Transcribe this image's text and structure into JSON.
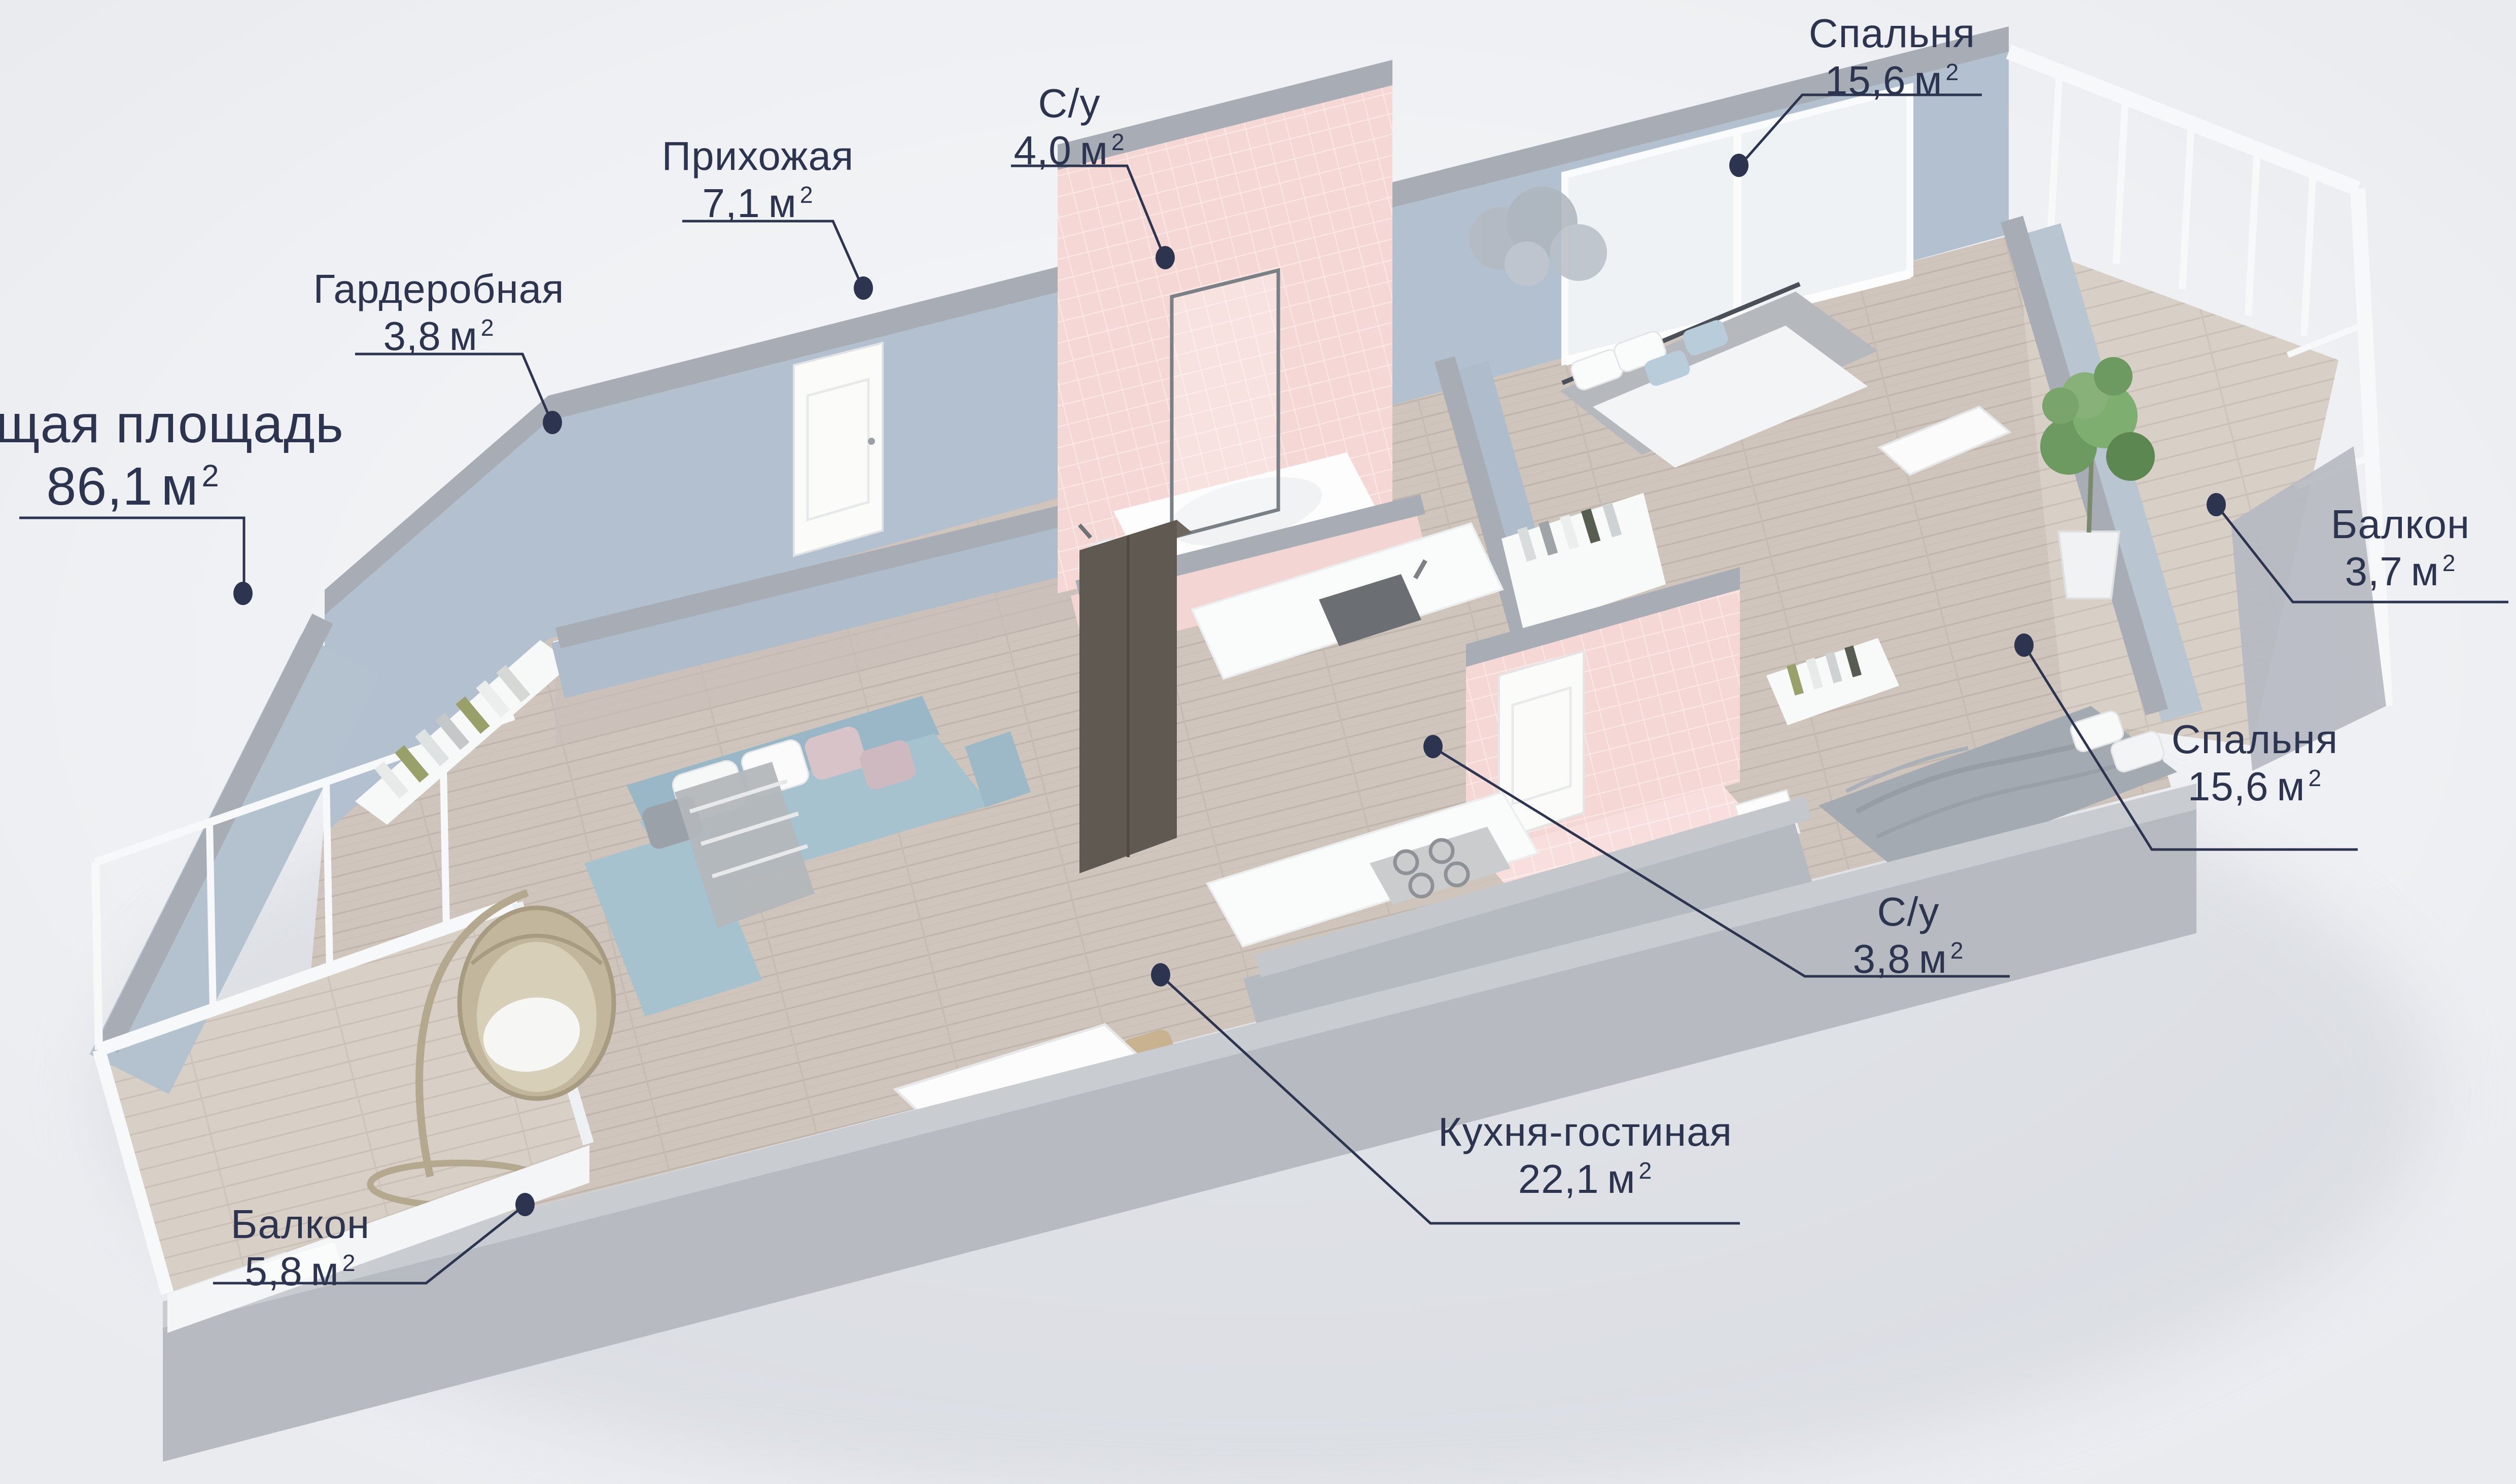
{
  "scene": {
    "type": "3d-floor-plan-render",
    "accent_color": "#2d3450",
    "background_color": "#eef0f3",
    "wall_blue": "#b2c0cf",
    "wall_cap_gray": "#a8adb5",
    "front_wall_gray": "#b7bac0",
    "wood_floor": "#cfc5bc",
    "tile_pink": "#f5d8d6",
    "sofa_blue": "#a7c2cf"
  },
  "overall": {
    "label": "Общая площадь",
    "area_value": "86,1",
    "area_unit": "м",
    "area_sup": "2"
  },
  "rooms": [
    {
      "key": "bedroom-back",
      "name": "Спальня",
      "area_value": "15,6",
      "area_unit": "м",
      "area_sup": "2"
    },
    {
      "key": "bathroom-back",
      "name": "С/у",
      "area_value": "4,0",
      "area_unit": "м",
      "area_sup": "2"
    },
    {
      "key": "hallway",
      "name": "Прихожая",
      "area_value": "7,1",
      "area_unit": "м",
      "area_sup": "2"
    },
    {
      "key": "wardrobe",
      "name": "Гардеробная",
      "area_value": "3,8",
      "area_unit": "м",
      "area_sup": "2"
    },
    {
      "key": "balcony-right",
      "name": "Балкон",
      "area_value": "3,7",
      "area_unit": "м",
      "area_sup": "2"
    },
    {
      "key": "bedroom-front",
      "name": "Спальня",
      "area_value": "15,6",
      "area_unit": "м",
      "area_sup": "2"
    },
    {
      "key": "bathroom-front",
      "name": "С/у",
      "area_value": "3,8",
      "area_unit": "м",
      "area_sup": "2"
    },
    {
      "key": "kitchen-living",
      "name": "Кухня-гостиная",
      "area_value": "22,1",
      "area_unit": "м",
      "area_sup": "2"
    },
    {
      "key": "balcony-left",
      "name": "Балкон",
      "area_value": "5,8",
      "area_unit": "м",
      "area_sup": "2"
    }
  ]
}
